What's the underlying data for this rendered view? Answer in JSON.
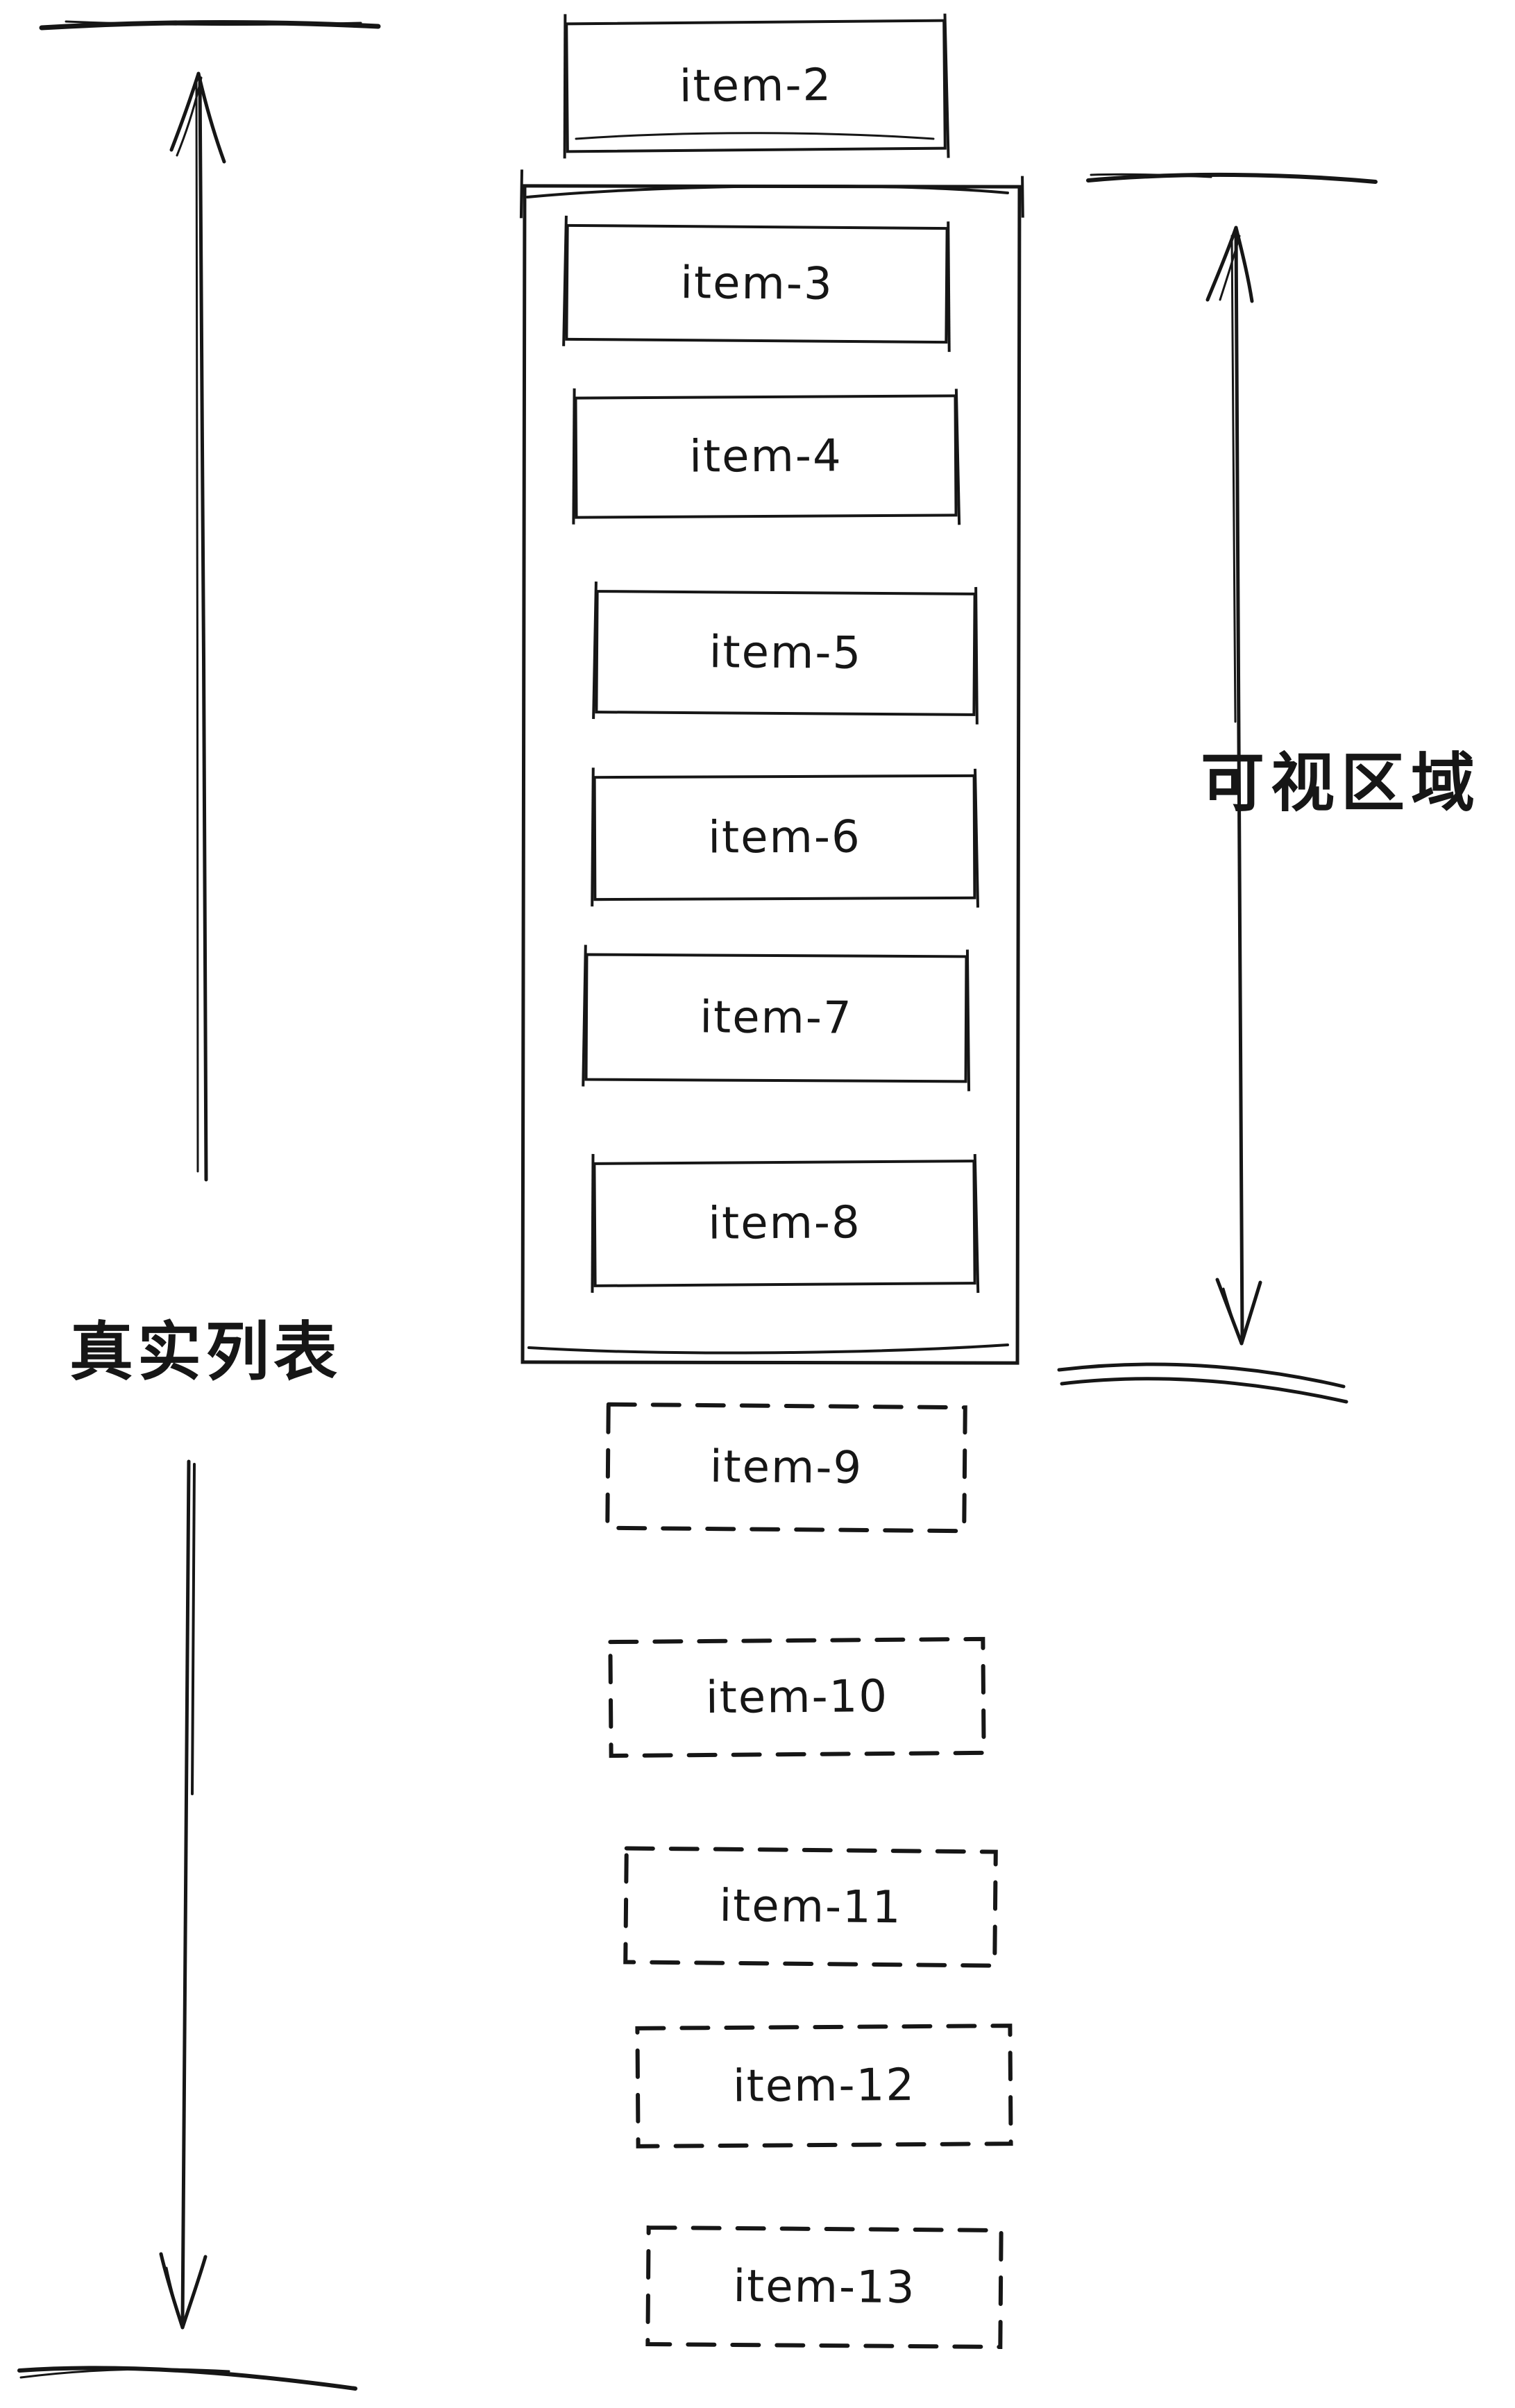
{
  "diagram": {
    "left_label": "真实列表",
    "right_label": "可视区域",
    "items": [
      {
        "label": "item-2",
        "border": "solid",
        "zone": "above-viewport"
      },
      {
        "label": "item-3",
        "border": "solid",
        "zone": "in-viewport"
      },
      {
        "label": "item-4",
        "border": "solid",
        "zone": "in-viewport"
      },
      {
        "label": "item-5",
        "border": "solid",
        "zone": "in-viewport"
      },
      {
        "label": "item-6",
        "border": "solid",
        "zone": "in-viewport"
      },
      {
        "label": "item-7",
        "border": "solid",
        "zone": "in-viewport"
      },
      {
        "label": "item-8",
        "border": "solid",
        "zone": "in-viewport"
      },
      {
        "label": "item-9",
        "border": "dashed",
        "zone": "below-viewport"
      },
      {
        "label": "item-10",
        "border": "dashed",
        "zone": "below-viewport"
      },
      {
        "label": "item-11",
        "border": "dashed",
        "zone": "below-viewport"
      },
      {
        "label": "item-12",
        "border": "dashed",
        "zone": "below-viewport"
      },
      {
        "label": "item-13",
        "border": "dashed",
        "zone": "below-viewport"
      }
    ],
    "colors": {
      "ink": "#161616",
      "background": "#ffffff"
    }
  }
}
